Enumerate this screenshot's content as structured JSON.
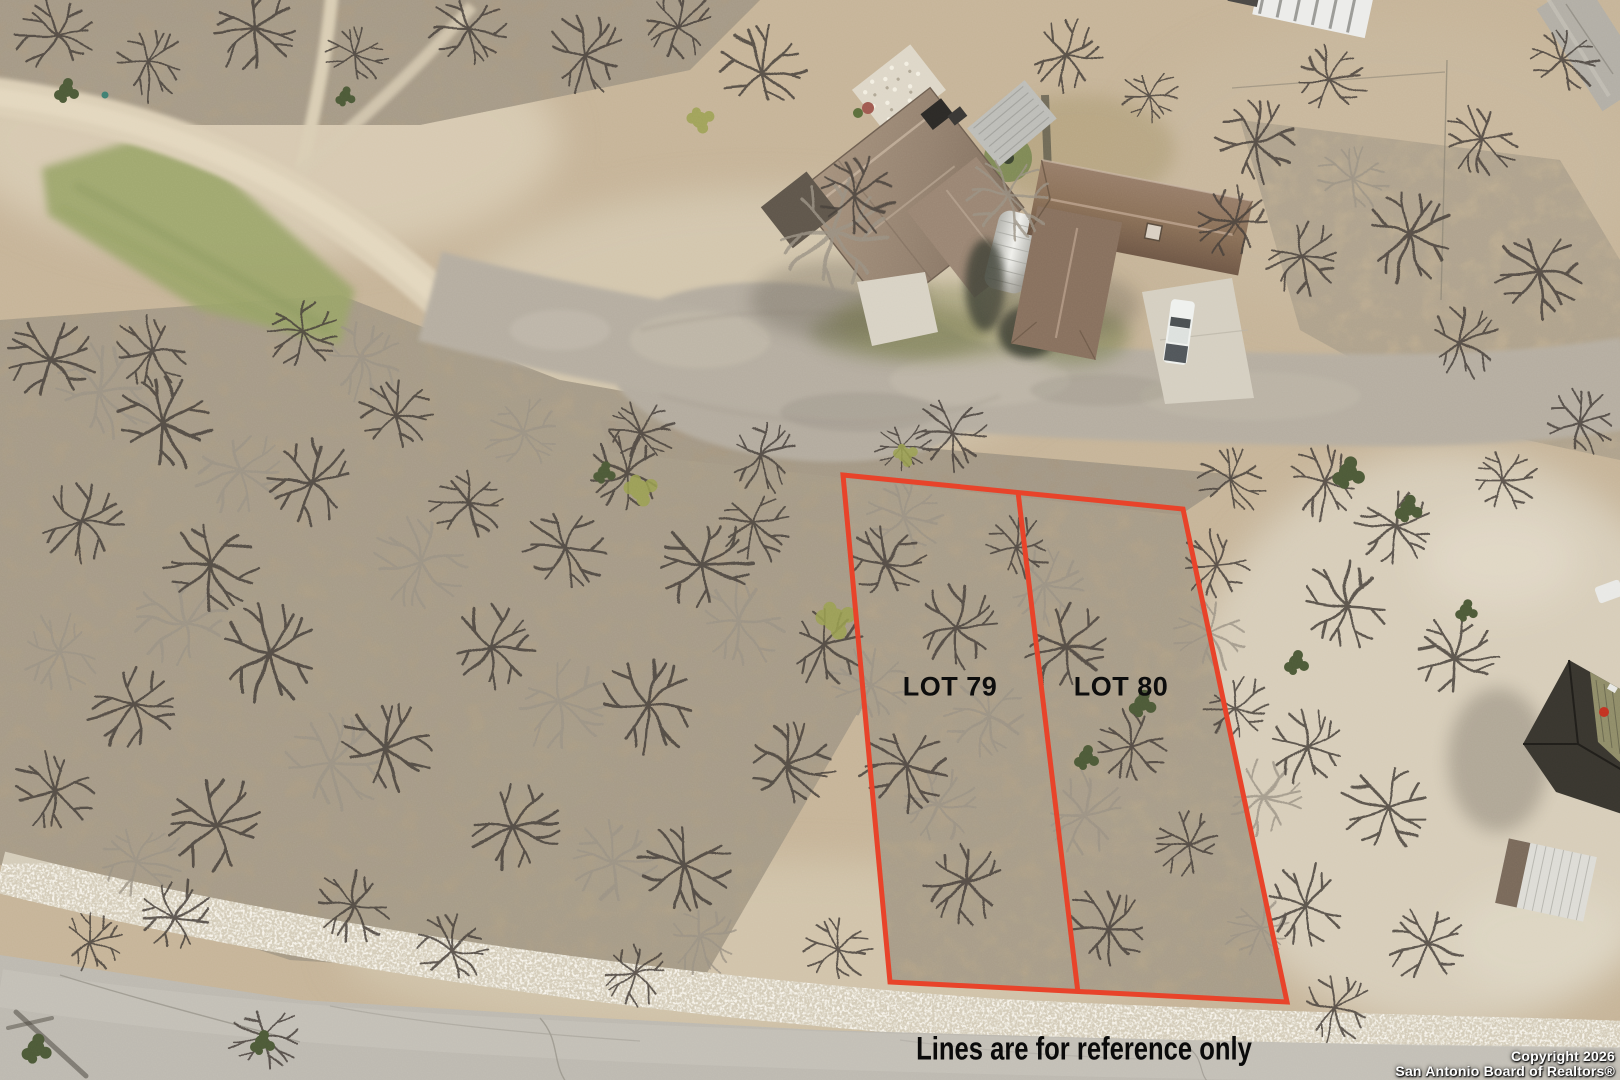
{
  "photo": {
    "description": "aerial drone photo of vacant scrubland lots beside curving residential roads"
  },
  "lot_overlay": {
    "lot79_label": "LOT 79",
    "lot80_label": "LOT 80",
    "disclaimer": "Lines are for reference only",
    "line_color": "#e8432a",
    "label_color": "#0d0d0d"
  },
  "watermark": {
    "line1": "Copyright 2026",
    "line2": "San Antonio Board of Realtors®",
    "text_color": "#ffffff"
  }
}
